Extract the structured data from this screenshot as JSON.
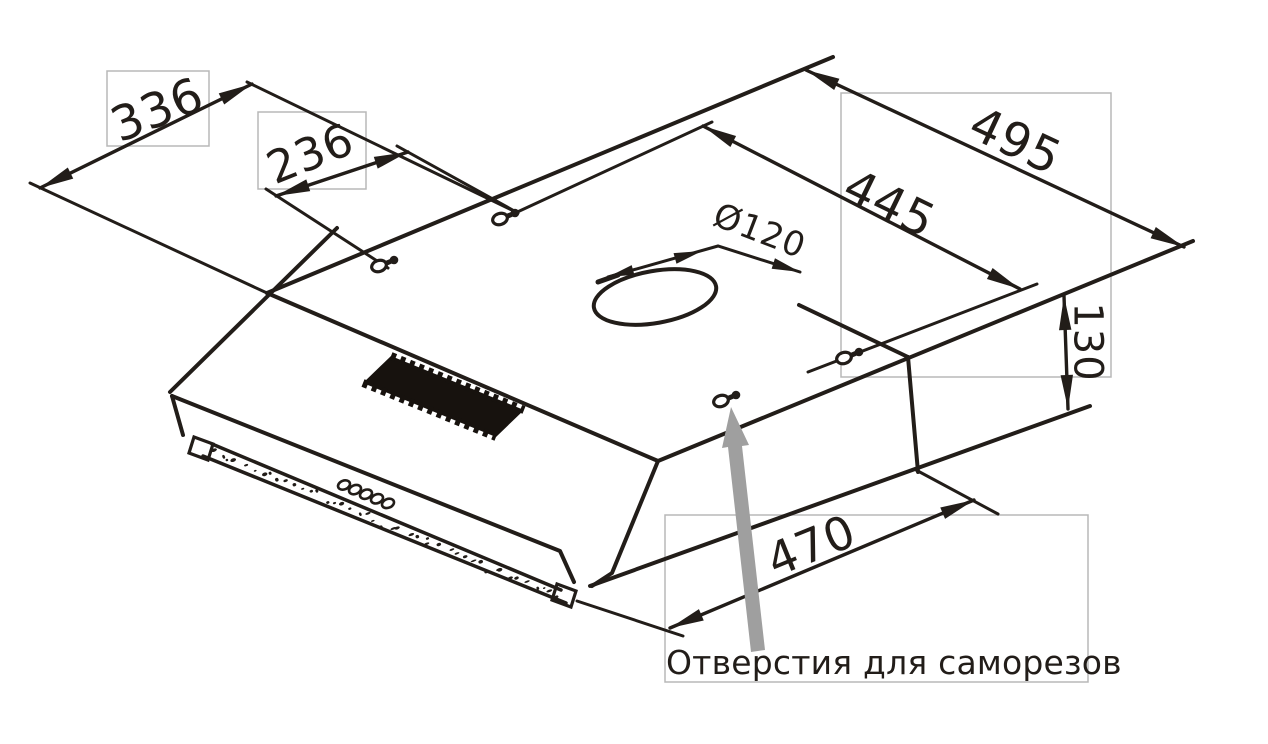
{
  "diagram": {
    "type": "technical-drawing",
    "dimensions": [
      {
        "id": "top-width",
        "value": "336"
      },
      {
        "id": "screw-spacing-left-pair",
        "value": "236"
      },
      {
        "id": "top-depth",
        "value": "495"
      },
      {
        "id": "screw-spacing-depth",
        "value": "445"
      },
      {
        "id": "duct-diameter",
        "value": "Ø120"
      },
      {
        "id": "body-height",
        "value": "130"
      },
      {
        "id": "screw-spacing-bottom",
        "value": "470"
      }
    ],
    "annotation": {
      "text": "Отверстия для саморезов"
    },
    "colors": {
      "line": "#221d19",
      "label_box_border": "#b8b8b8",
      "pointer_arrow": "#9f9f9f",
      "grille": "#17120e",
      "background": "#ffffff"
    }
  }
}
